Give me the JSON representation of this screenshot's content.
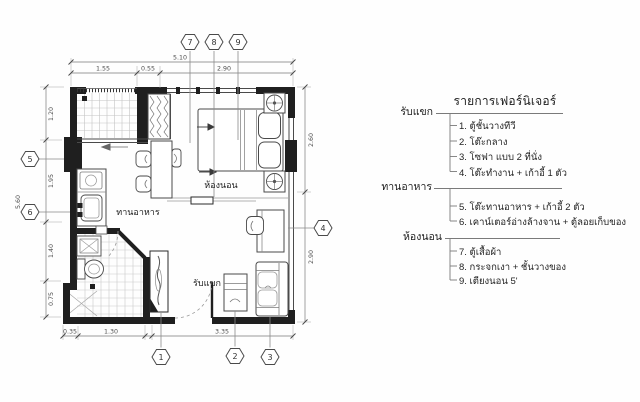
{
  "plan": {
    "room_labels": {
      "bedroom": "ห้องนอน",
      "dining": "ทานอาหาร",
      "living": "รับแขก"
    },
    "dimensions": {
      "top": {
        "total": "5.10",
        "segments": [
          "1.55",
          "0.55",
          "2.90"
        ]
      },
      "left": {
        "total": "5.60",
        "segments": [
          "1.20",
          "1.95",
          "1.40",
          "0.75"
        ]
      },
      "right": {
        "segments": [
          "2.60",
          "2.90"
        ]
      },
      "bottom": {
        "segments": [
          "0.35",
          "1.30",
          "3.35"
        ]
      }
    },
    "markers": {
      "top": [
        "7",
        "8",
        "9"
      ],
      "bottom": [
        "1",
        "2",
        "3"
      ],
      "left": [
        "5",
        "6"
      ],
      "right": [
        "4"
      ]
    }
  },
  "furniture_list": {
    "title": "รายการเฟอร์นิเจอร์",
    "groups": [
      {
        "label": "รับแขก",
        "items": [
          "1. ตู้ชั้นวางทีวี",
          "2. โต๊ะกลาง",
          "3. โซฟา แบบ 2 ที่นั่ง",
          "4. โต๊ะทำงาน + เก้าอี้ 1 ตัว"
        ]
      },
      {
        "label": "ทานอาหาร",
        "items": [
          "5. โต๊ะทานอาหาร + เก้าอี้ 2 ตัว",
          "6. เคาน์เตอร์อ่างล้างจาน + ตู้ลอยเก็บของ"
        ]
      },
      {
        "label": "ห้องนอน",
        "items": [
          "7. ตู้เสื้อผ้า",
          "8. กระจกเงา + ชั้นวางของ",
          "9. เตียงนอน 5'"
        ]
      }
    ]
  },
  "colors": {
    "paper": "#fefefe",
    "ink": "#1f1f1f",
    "line_mid": "#4a4a4a",
    "line_light": "#9a9a9a",
    "tile_grid": "#c3c3c3",
    "dim_text": "#4d4d4d"
  }
}
